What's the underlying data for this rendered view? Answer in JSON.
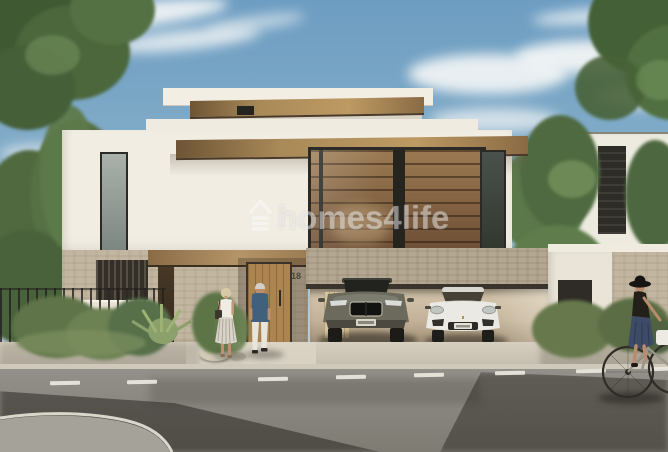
{
  "scene": {
    "kind": "architectural-exterior-render",
    "watermark": {
      "text": "homes4life",
      "icon": "homes4life-house-icon",
      "color": "#ffffff",
      "opacity": 0.42
    },
    "house": {
      "number": "18"
    },
    "vehicles": [
      {
        "name": "dark-suv",
        "color": "#6c6a5d"
      },
      {
        "name": "white-suv",
        "color": "#eae9e4"
      }
    ],
    "palette": {
      "sky_top": "#6d9dc2",
      "sky_horizon": "#ccd7db",
      "cloud": "#f5f7f7",
      "wall_white": "#f1ede3",
      "wood": "#a9854f",
      "stone": "#c2b6a1",
      "window_frame": "#2b2a26",
      "interior_wood": "#8a6647",
      "foliage_dark": "#46613a",
      "foliage_light": "#6d8c57",
      "road": "#8f8c84",
      "road_shadow": "#36322b",
      "sidewalk": "#d3ccbd",
      "lane_marking": "#eae8e0",
      "door_wood": "#ab8450"
    }
  }
}
